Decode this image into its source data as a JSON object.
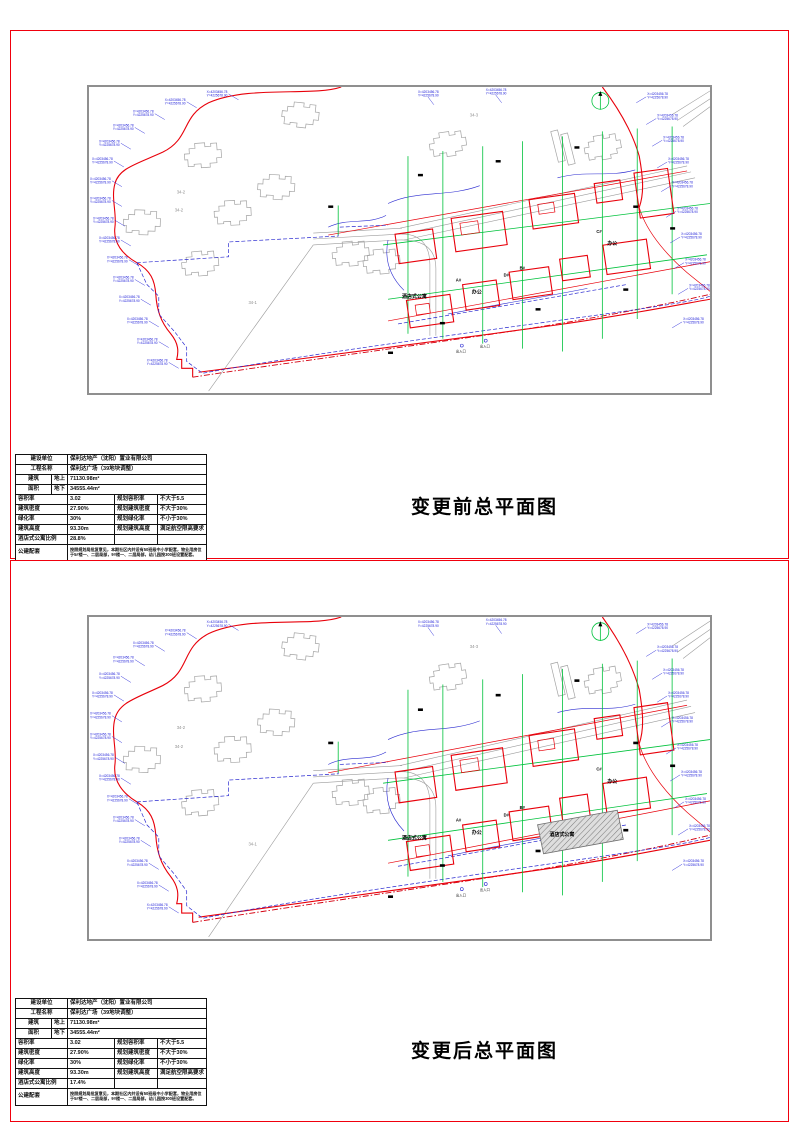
{
  "colors": {
    "sheet_border_red": "#f0000d",
    "boundary_red": "#e8000a",
    "parcel_blue": "#2a2ad0",
    "utility_green": "#00c23c",
    "frame_gray": "#8f8f8f"
  },
  "labels": {
    "r1": "建设单位",
    "r2": "工程名称",
    "r3a": "建筑",
    "r3b": "面积",
    "r3u": "地上",
    "r3d": "地下",
    "r4": "容积率",
    "r4p": "规划容积率",
    "r5": "建筑密度",
    "r5p": "规划建筑密度",
    "r6": "绿化率",
    "r6p": "规划绿化率",
    "r7": "建筑高度",
    "r7p": "规划建筑高度",
    "r8": "酒店式公寓比例",
    "r9": "公建配套"
  },
  "shared": {
    "company": "保利达地产（沈阳）置业有限公司",
    "project": "保利达广场（39地块调整）",
    "above": "71130.98m²",
    "below": "34555.44m²",
    "far": "3.02",
    "far_limit": "不大于5.5",
    "density": "27.90%",
    "density_limit": "不大于30%",
    "green": "30%",
    "green_limit": "不小于30%",
    "height": "93.30m",
    "height_limit": "满足航空限高要求",
    "amenity": "按照规划局批复意见，本期社区内共设有50班级中小学配套，物业用房位于5#楼一、二层局部，9#楼一、二层局部，幼儿园按300班设置配套。"
  },
  "sheets": {
    "before": {
      "title": "变更前总平面图",
      "apartment_ratio": "28.8%"
    },
    "after": {
      "title": "变更后总平面图",
      "apartment_ratio": "17.4%"
    }
  },
  "plan": {
    "north": "北",
    "apartment": "酒店式公寓",
    "office": "办公",
    "bldg_a": "A#",
    "bldg_b": "B#",
    "bldg_c": "C#",
    "bldg_d": "D#",
    "parcel_341": "34-1",
    "parcel_342": "34-2",
    "parcel_343": "34-3",
    "entrance": "出入口",
    "coord_x": "X=4203456.78",
    "coord_y": "Y=4225678.90"
  }
}
